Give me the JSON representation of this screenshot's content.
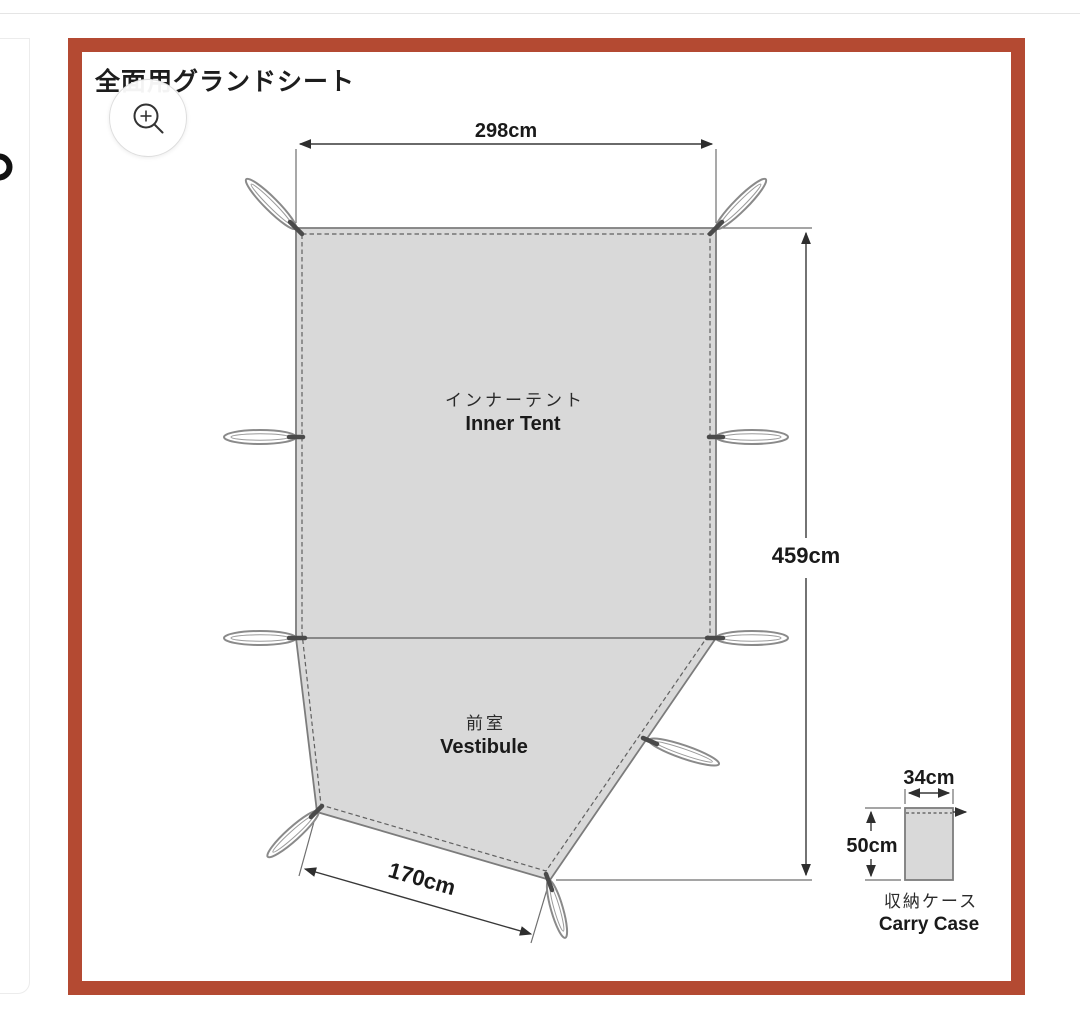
{
  "header": {
    "title": "全面用グランドシート"
  },
  "icons": {
    "zoom": "magnifier-plus-icon",
    "side_glyph": "partial-circle-glyph"
  },
  "diagram": {
    "top_width_label": "298cm",
    "length_label": "459cm",
    "bottom_width_label": "170cm",
    "inner_tent_jp": "インナーテント",
    "inner_tent_en": "Inner Tent",
    "vestibule_jp": "前室",
    "vestibule_en": "Vestibule"
  },
  "carry_case": {
    "width_label": "34cm",
    "height_label": "50cm",
    "name_jp": "収納ケース",
    "name_en": "Carry Case"
  },
  "colors": {
    "frame_red": "#b44a32",
    "fabric_gray": "#d9d9d9",
    "line_dark": "#383838"
  }
}
